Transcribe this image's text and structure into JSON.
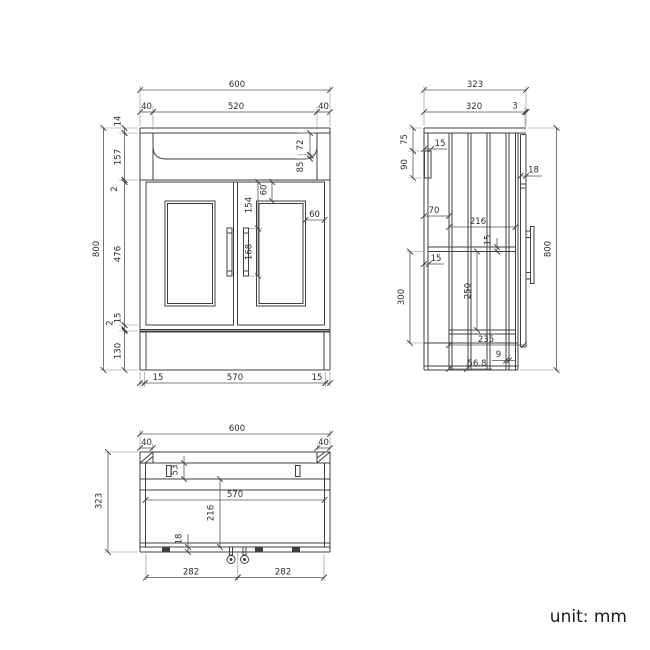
{
  "unit_label": "unit: mm",
  "front_view": {
    "overall_width": "600",
    "rim_left": "40",
    "basin_width": "520",
    "rim_right": "40",
    "countertop_thickness": "14",
    "basin_section_height": "157",
    "gap_above_doors": "2",
    "door_height": "476",
    "gap_below_doors": "15",
    "bottom_panel_gap": "2",
    "plinth_height": "130",
    "overall_height": "800",
    "basin_depth": "72",
    "basin_outer_depth": "85",
    "door_frame_top_inset": "60",
    "handle_top_offset": "154",
    "handle_length": "168",
    "door_frame_side_inset": "60",
    "side_panel_left": "15",
    "internal_width": "570",
    "side_panel_right": "15"
  },
  "side_view": {
    "overall_depth": "323",
    "carcass_depth": "320",
    "door_clearance": "3",
    "bracket_top_offset": "75",
    "bracket_height": "90",
    "bracket_depth": "15",
    "top_rail_depth": "70",
    "internal_depth": "216",
    "rail_thickness": "15",
    "back_panel_thickness": "15",
    "service_gap": "300",
    "shelf_depth": "250",
    "door_thickness": "18",
    "overall_height": "800",
    "base_internal_depth": "235",
    "pipe_hole_width": "9",
    "pipe_hole_offset": "56.8"
  },
  "plan_view": {
    "overall_width": "600",
    "corner_left": "40",
    "corner_right": "40",
    "back_rail_depth": "53",
    "internal_width": "570",
    "internal_depth": "216",
    "door_thickness": "18",
    "fixing_left_spacing": "282",
    "fixing_right_spacing": "282",
    "overall_depth": "323"
  }
}
